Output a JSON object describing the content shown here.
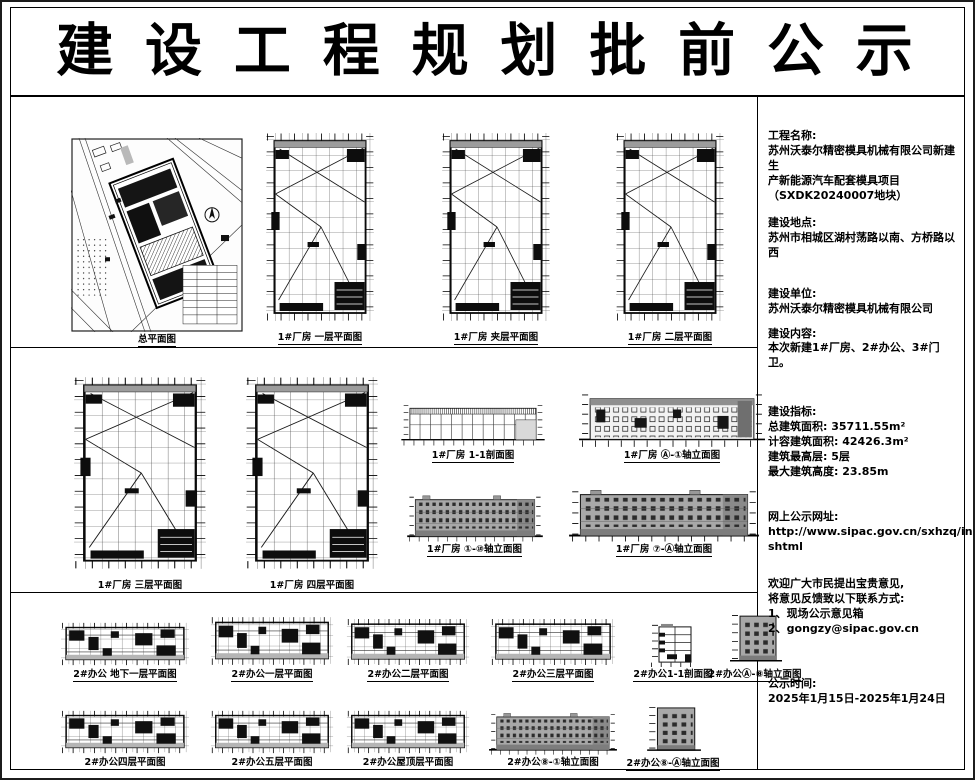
{
  "page": {
    "title": "建 设 工 程 规 划 批 前 公 示"
  },
  "info_panel": {
    "sections": [
      {
        "heading": "工程名称:",
        "body": "苏州沃泰尔精密模具机械有限公司新建生\n产新能源汽车配套模具项目\n（SXDK20240007地块）"
      },
      {
        "heading": "建设地点:",
        "body": "苏州市相城区湖村荡路以南、方桥路以西"
      },
      {
        "heading": "建设单位:",
        "body": "苏州沃泰尔精密模具机械有限公司"
      },
      {
        "heading": "建设内容:",
        "body": "本次新建1#厂房、2#办公、3#门卫。"
      },
      {
        "heading": "建设指标:",
        "body": "总建筑面积: 35711.55m²\n计容建筑面积: 42426.3m²\n建筑最高层: 5层\n最大建筑高度: 23.85m"
      },
      {
        "heading": "网上公示网址:",
        "body": "http://www.sipac.gov.cn/sxhzq/index.\nshtml"
      },
      {
        "heading": "欢迎广大市民提出宝贵意见,",
        "body": "将意见反馈致以下联系方式:\n1、现场公示意见箱\n2、gongzy@sipac.gov.cn"
      },
      {
        "heading": "公示时间:",
        "body": "2025年1月15日-2025年1月24日"
      }
    ]
  },
  "figures": {
    "r1": [
      {
        "label": "总平面图"
      },
      {
        "label": "1#厂房 一层平面图"
      },
      {
        "label": "1#厂房 夹层平面图"
      },
      {
        "label": "1#厂房 二层平面图"
      }
    ],
    "r2": [
      {
        "label": "1#厂房 三层平面图"
      },
      {
        "label": "1#厂房 四层平面图"
      },
      {
        "label": "1#厂房 1-1剖面图"
      },
      {
        "label": "1#厂房 Ⓐ-①轴立面图"
      },
      {
        "label": "1#厂房 ①-⑩轴立面图"
      },
      {
        "label": "1#厂房 ⑦-Ⓐ轴立面图"
      }
    ],
    "r3": [
      {
        "label": "2#办公 地下一层平面图"
      },
      {
        "label": "2#办公一层平面图"
      },
      {
        "label": "2#办公二层平面图"
      },
      {
        "label": "2#办公三层平面图"
      },
      {
        "label": "2#办公1-1剖面图"
      },
      {
        "label": "2#办公Ⓐ-⑧轴立面图"
      }
    ],
    "r4": [
      {
        "label": "2#办公四层平面图"
      },
      {
        "label": "2#办公五层平面图"
      },
      {
        "label": "2#办公屋顶层平面图"
      },
      {
        "label": "2#办公⑧-①轴立面图"
      },
      {
        "label": "2#办公⑧-Ⓐ轴立面图"
      }
    ]
  },
  "colors": {
    "line": "#111111",
    "elevation_gray": "#a8a8a8",
    "paper": "#ffffff"
  }
}
